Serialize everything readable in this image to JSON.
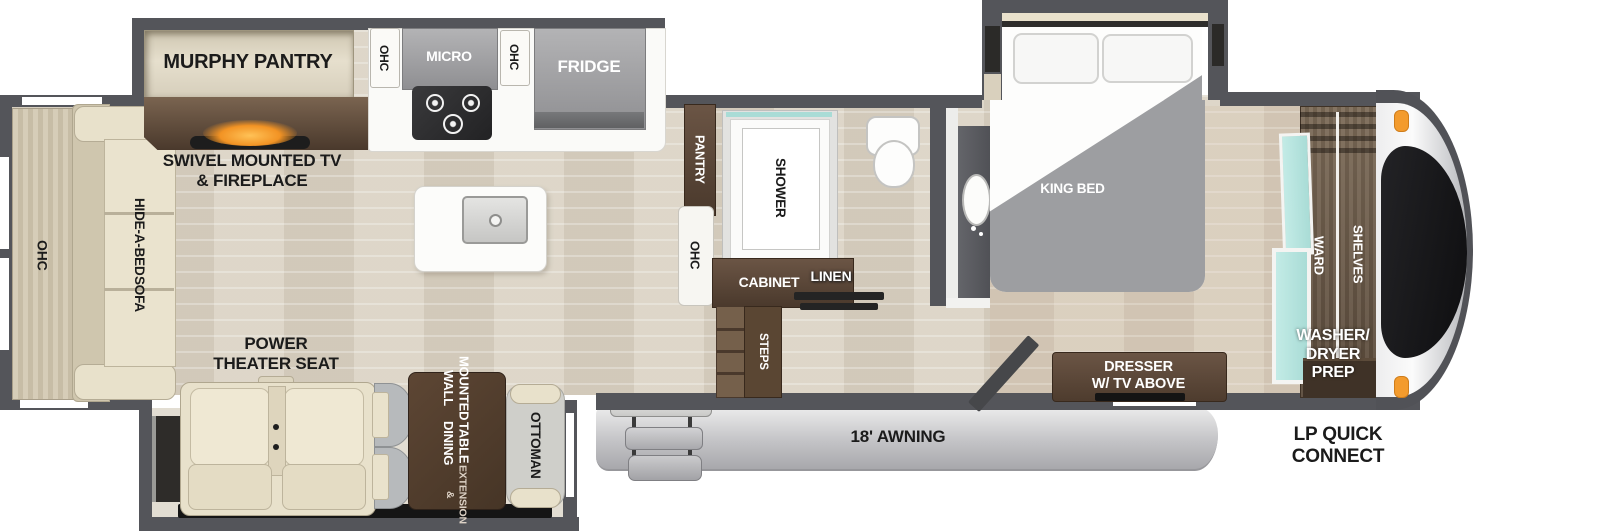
{
  "colors": {
    "wall": "#54555a",
    "floor": "#d9d1c2",
    "slide_floor": "#e2ddd2",
    "cream": "#e8e1cb",
    "cream_light": "#efe8d3",
    "brown_dark": "#4e3b2b",
    "brown_mid": "#6a5847",
    "appliance_gray": "#9b9b9d",
    "bed_gray": "#9d9ea1",
    "teal": "#a9dcd6",
    "orange_light": "#f39b2d",
    "fireplace_glow": "#f29324",
    "awning_gray": "#c7c7ca",
    "black_trim": "#151515"
  },
  "labels": {
    "rear": {
      "ohc": "OHC",
      "sofa_line1": "HIDE-A-BED",
      "sofa_line2": "SOFA"
    },
    "living": {
      "murphy": "MURPHY PANTRY",
      "swivel_line1": "SWIVEL MOUNTED TV",
      "swivel_line2": "& FIREPLACE",
      "theater_line1": "POWER",
      "theater_line2": "THEATER SEAT"
    },
    "kitchen": {
      "ohc_left": "OHC",
      "micro": "MICRO",
      "ohc_right": "OHC",
      "fridge": "FRIDGE",
      "pantry": "PANTRY",
      "ohc_bath": "OHC"
    },
    "dinette": {
      "table_line1": "WALL MOUNTED",
      "table_line2": "DINING TABLE",
      "table_line3": "& EXTENSION",
      "ottoman": "OTTOMAN"
    },
    "bath": {
      "shower": "SHOWER",
      "cabinet": "CABINET",
      "linen": "LINEN",
      "steps": "STEPS"
    },
    "bedroom": {
      "king_bed": "KING BED",
      "dresser_line1": "DRESSER",
      "dresser_line2": "W/ TV ABOVE"
    },
    "front": {
      "ward": "WARD",
      "shelves": "SHELVES",
      "wd_line1": "WASHER/",
      "wd_line2": "DRYER",
      "wd_line3": "PREP"
    },
    "exterior": {
      "awning": "18' AWNING",
      "lp_line1": "LP QUICK",
      "lp_line2": "CONNECT"
    }
  }
}
